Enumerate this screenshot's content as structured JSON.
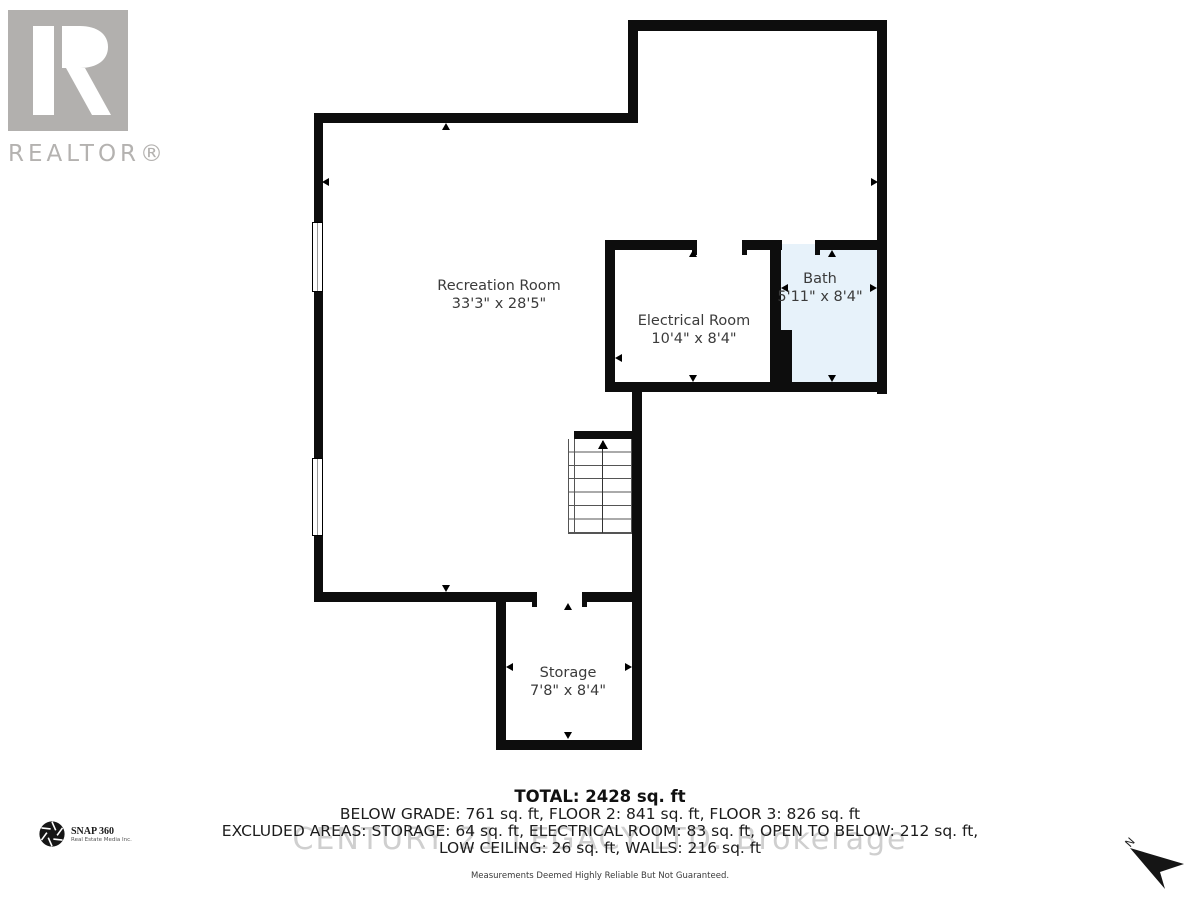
{
  "branding": {
    "realtor_label": "REALTOR®",
    "snap360": {
      "name": "SNAP 360",
      "subtitle": "Real Estate Media Inc."
    },
    "watermark": "CENTURY 21 LEGACY LTD. Brokerage",
    "north_label": "N"
  },
  "rooms": [
    {
      "name": "Recreation Room",
      "dims": "33'3\" x 28'5\""
    },
    {
      "name": "Electrical Room",
      "dims": "10'4\" x 8'4\""
    },
    {
      "name": "Bath",
      "dims": "5'11\" x 8'4\""
    },
    {
      "name": "Storage",
      "dims": "7'8\" x 8'4\""
    }
  ],
  "summary": {
    "total": "TOTAL: 2428 sq. ft",
    "line2": "BELOW GRADE: 761 sq. ft, FLOOR 2: 841 sq. ft, FLOOR 3: 826 sq. ft",
    "line3": "EXCLUDED AREAS: STORAGE: 64 sq. ft, ELECTRICAL ROOM: 83 sq. ft, OPEN TO BELOW: 212 sq. ft,",
    "line4": "LOW CEILING: 26 sq. ft, WALLS: 216 sq. ft",
    "disclaimer": "Measurements Deemed Highly Reliable But Not Guaranteed."
  },
  "colors": {
    "wall": "#0d0d0d",
    "bath_fill": "#e7f2fa",
    "logo_gray": "#b2b0ae",
    "watermark_gray": "#cfcfcf"
  }
}
